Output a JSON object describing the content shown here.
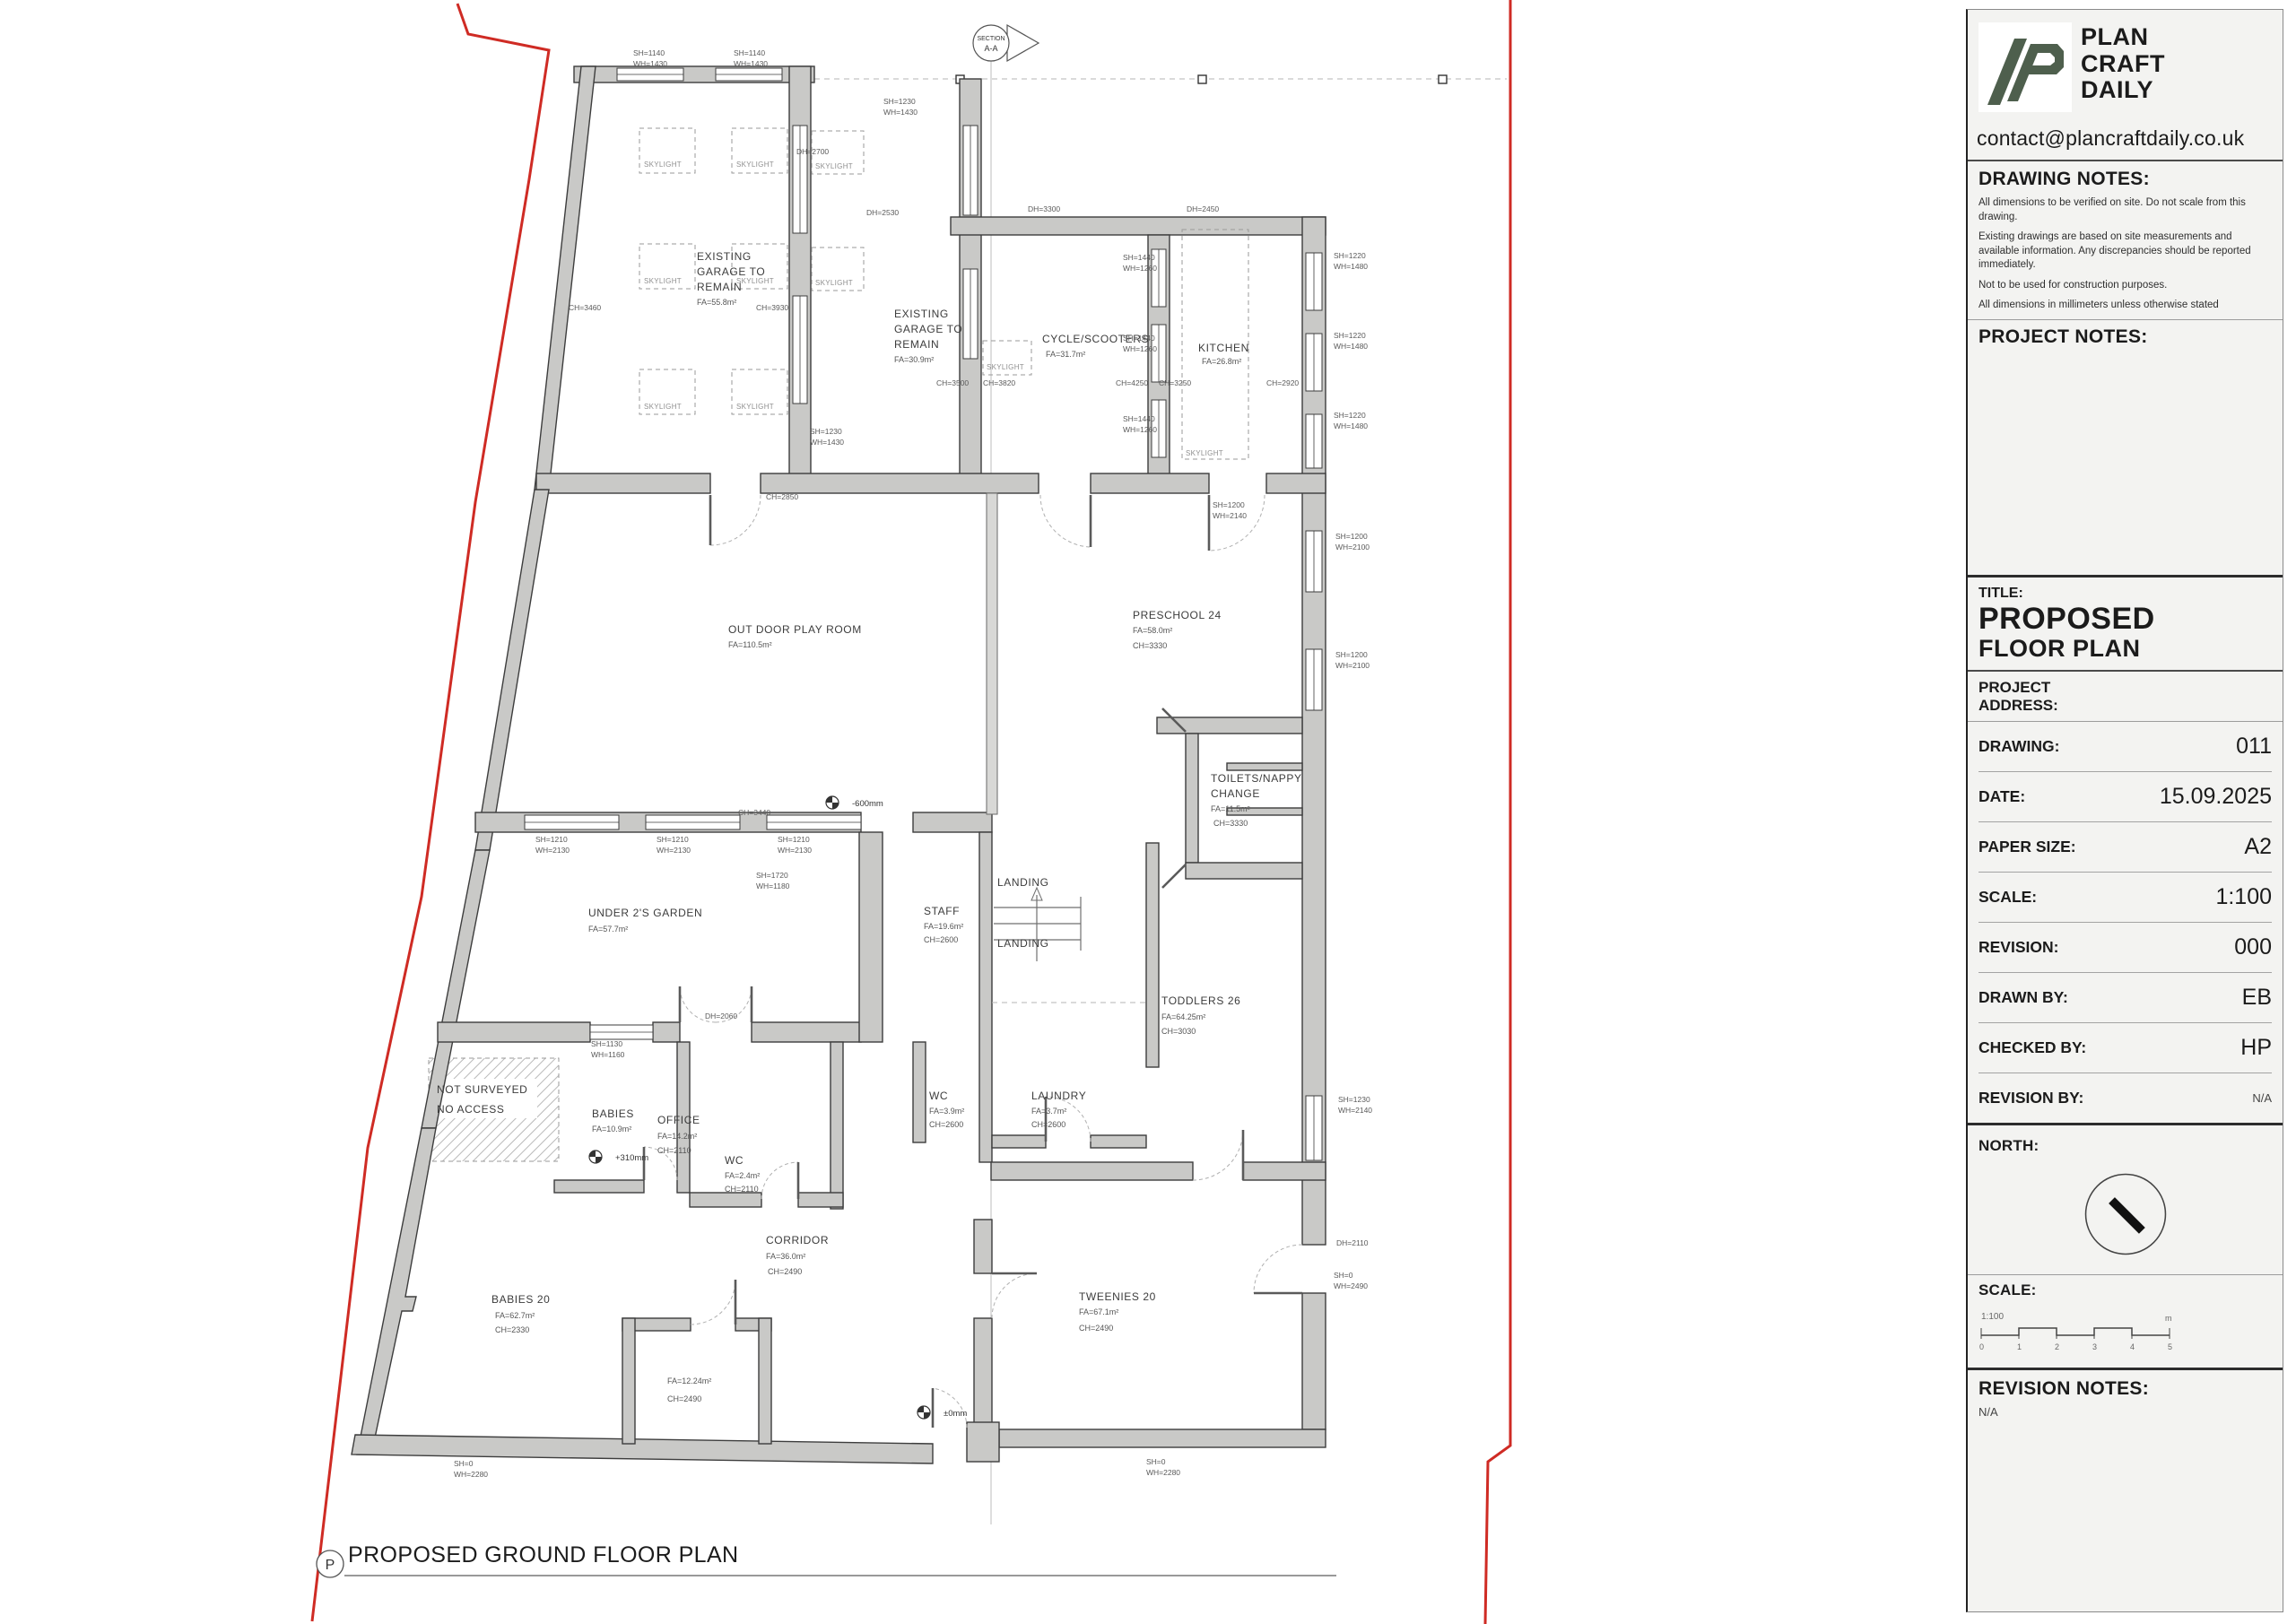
{
  "colors": {
    "logo_green": "#4e5f4d",
    "boundary_red": "#cf2b24",
    "wall_gray": "#c9c9c7"
  },
  "title_block": {
    "brand": {
      "name_lines": [
        "PLAN",
        "CRAFT",
        "DAILY"
      ],
      "email": "contact@plancraftdaily.co.uk"
    },
    "drawing_notes": {
      "heading": "DRAWING NOTES:",
      "notes": [
        "All dimensions to be verified on site. Do not scale from this drawing.",
        "Existing drawings are based on site measurements and available information. Any discrepancies should be reported immediately.",
        "Not to be used for construction purposes.",
        "All dimensions in millimeters unless otherwise stated"
      ]
    },
    "project_notes": {
      "heading": "PROJECT NOTES:"
    },
    "title": {
      "label": "TITLE:",
      "line1": "PROPOSED",
      "line2": "FLOOR PLAN"
    },
    "address_label": "PROJECT\nADDRESS:",
    "fields": [
      {
        "label": "DRAWING:",
        "value": "011"
      },
      {
        "label": "DATE:",
        "value": "15.09.2025"
      },
      {
        "label": "PAPER SIZE:",
        "value": "A2"
      },
      {
        "label": "SCALE:",
        "value": "1:100"
      },
      {
        "label": "REVISION:",
        "value": "000"
      },
      {
        "label": "DRAWN BY:",
        "value": "EB"
      },
      {
        "label": "CHECKED BY:",
        "value": "HP"
      },
      {
        "label": "REVISION BY:",
        "value": "N/A"
      }
    ],
    "north_label": "NORTH:",
    "scale_bar": {
      "label": "SCALE:",
      "ratio": "1:100",
      "ticks": [
        "0",
        "1",
        "2",
        "3",
        "4",
        "5"
      ],
      "unit": "m"
    },
    "revision_notes": {
      "heading": "REVISION NOTES:",
      "value": "N/A"
    }
  },
  "plan": {
    "caption": {
      "marker": "P",
      "title": "PROPOSED GROUND FLOOR PLAN"
    },
    "section_marker": {
      "line1": "SECTION",
      "line2": "A-A"
    },
    "labels": [
      [
        "EXISTING",
        777,
        290,
        "room"
      ],
      [
        "GARAGE TO",
        777,
        307,
        "room"
      ],
      [
        "REMAIN",
        777,
        324,
        "room"
      ],
      [
        "FA=55.8m²",
        777,
        340,
        "sub"
      ],
      [
        "EXISTING",
        997,
        354,
        "room"
      ],
      [
        "GARAGE TO",
        997,
        371,
        "room"
      ],
      [
        "REMAIN",
        997,
        388,
        "room"
      ],
      [
        "FA=30.9m²",
        997,
        404,
        "sub"
      ],
      [
        "CYCLE/SCOOTERS",
        1162,
        382,
        "room"
      ],
      [
        "FA=31.7m²",
        1166,
        398,
        "sub"
      ],
      [
        "KITCHEN",
        1336,
        392,
        "room"
      ],
      [
        "FA=26.8m²",
        1340,
        406,
        "sub"
      ],
      [
        "OUT DOOR PLAY ROOM",
        812,
        706,
        "room"
      ],
      [
        "FA=110.5m²",
        812,
        722,
        "sub"
      ],
      [
        "PRESCHOOL 24",
        1263,
        690,
        "room"
      ],
      [
        "FA=58.0m²",
        1263,
        706,
        "sub"
      ],
      [
        "CH=3330",
        1263,
        723,
        "sub"
      ],
      [
        "TOILETS/NAPPY",
        1350,
        872,
        "room"
      ],
      [
        "CHANGE",
        1350,
        889,
        "room"
      ],
      [
        "FA=11.5m²",
        1350,
        905,
        "sub"
      ],
      [
        "CH=3330",
        1353,
        921,
        "sub"
      ],
      [
        "UNDER 2'S GARDEN",
        656,
        1022,
        "room"
      ],
      [
        "FA=57.7m²",
        656,
        1039,
        "sub"
      ],
      [
        "STAFF",
        1030,
        1020,
        "room"
      ],
      [
        "FA=19.6m²",
        1030,
        1036,
        "sub"
      ],
      [
        "CH=2600",
        1030,
        1051,
        "sub"
      ],
      [
        "LANDING",
        1112,
        988,
        "room"
      ],
      [
        "LANDING",
        1112,
        1056,
        "room"
      ],
      [
        "TODDLERS 26",
        1295,
        1120,
        "room"
      ],
      [
        "FA=64.25m²",
        1295,
        1137,
        "sub"
      ],
      [
        "CH=3030",
        1295,
        1153,
        "sub"
      ],
      [
        "NOT SURVEYED",
        487,
        1219,
        "room"
      ],
      [
        "NO ACCESS",
        487,
        1241,
        "room"
      ],
      [
        "BABIES",
        660,
        1246,
        "room"
      ],
      [
        "FA=10.9m²",
        660,
        1262,
        "sub"
      ],
      [
        "OFFICE",
        733,
        1253,
        "room"
      ],
      [
        "FA=14.2m²",
        733,
        1270,
        "sub"
      ],
      [
        "CH=2110",
        733,
        1286,
        "sub"
      ],
      [
        "WC",
        1036,
        1226,
        "room"
      ],
      [
        "FA=3.9m²",
        1036,
        1242,
        "sub"
      ],
      [
        "CH=2600",
        1036,
        1257,
        "sub"
      ],
      [
        "LAUNDRY",
        1150,
        1226,
        "room"
      ],
      [
        "FA=3.7m²",
        1150,
        1242,
        "sub"
      ],
      [
        "CH=2600",
        1150,
        1257,
        "sub"
      ],
      [
        "WC",
        808,
        1298,
        "room"
      ],
      [
        "FA=2.4m²",
        808,
        1314,
        "sub"
      ],
      [
        "CH=2110",
        808,
        1329,
        "sub"
      ],
      [
        "CORRIDOR",
        854,
        1387,
        "room"
      ],
      [
        "FA=36.0m²",
        854,
        1404,
        "sub"
      ],
      [
        "CH=2490",
        856,
        1421,
        "sub"
      ],
      [
        "BABIES 20",
        548,
        1453,
        "room"
      ],
      [
        "FA=62.7m²",
        552,
        1470,
        "sub"
      ],
      [
        "CH=2330",
        552,
        1486,
        "sub"
      ],
      [
        "FA=12.24m²",
        744,
        1543,
        "sub"
      ],
      [
        "CH=2490",
        744,
        1563,
        "sub"
      ],
      [
        "TWEENIES 20",
        1203,
        1450,
        "room"
      ],
      [
        "FA=67.1m²",
        1203,
        1466,
        "sub"
      ],
      [
        "CH=2490",
        1203,
        1484,
        "sub"
      ],
      [
        "SKYLIGHT",
        718,
        186,
        "skl"
      ],
      [
        "SKYLIGHT",
        821,
        186,
        "skl"
      ],
      [
        "SKYLIGHT",
        718,
        316,
        "skl"
      ],
      [
        "SKYLIGHT",
        821,
        316,
        "skl"
      ],
      [
        "SKYLIGHT",
        718,
        456,
        "skl"
      ],
      [
        "SKYLIGHT",
        821,
        456,
        "skl"
      ],
      [
        "SKYLIGHT",
        909,
        188,
        "skl"
      ],
      [
        "SKYLIGHT",
        909,
        318,
        "skl"
      ],
      [
        "SKYLIGHT",
        1100,
        412,
        "skl"
      ],
      [
        "SKYLIGHT",
        1322,
        508,
        "skl"
      ],
      [
        "SH=1140",
        706,
        62,
        "dim"
      ],
      [
        "WH=1430",
        706,
        74,
        "dim"
      ],
      [
        "SH=1140",
        818,
        62,
        "dim"
      ],
      [
        "WH=1430",
        818,
        74,
        "dim"
      ],
      [
        "DH=2700",
        888,
        172,
        "dim"
      ],
      [
        "SH=1230",
        985,
        116,
        "dim"
      ],
      [
        "WH=1430",
        985,
        128,
        "dim"
      ],
      [
        "DH=2530",
        966,
        240,
        "dim"
      ],
      [
        "DH=3300",
        1146,
        236,
        "dim"
      ],
      [
        "DH=2450",
        1323,
        236,
        "dim"
      ],
      [
        "SH=1440",
        1252,
        290,
        "dim"
      ],
      [
        "WH=1260",
        1252,
        302,
        "dim"
      ],
      [
        "SH=1440",
        1252,
        380,
        "dim"
      ],
      [
        "WH=1260",
        1252,
        392,
        "dim"
      ],
      [
        "SH=1440",
        1252,
        470,
        "dim"
      ],
      [
        "WH=1260",
        1252,
        482,
        "dim"
      ],
      [
        "SH=1220",
        1487,
        288,
        "dim"
      ],
      [
        "WH=1480",
        1487,
        300,
        "dim"
      ],
      [
        "SH=1220",
        1487,
        377,
        "dim"
      ],
      [
        "WH=1480",
        1487,
        389,
        "dim"
      ],
      [
        "SH=1220",
        1487,
        466,
        "dim"
      ],
      [
        "WH=1480",
        1487,
        478,
        "dim"
      ],
      [
        "CH=3460",
        634,
        346,
        "dim"
      ],
      [
        "CH=3930",
        843,
        346,
        "dim"
      ],
      [
        "CH=3500",
        1044,
        430,
        "dim"
      ],
      [
        "CH=3820",
        1096,
        430,
        "dim"
      ],
      [
        "CH=4250",
        1244,
        430,
        "dim"
      ],
      [
        "CH=3250",
        1292,
        430,
        "dim"
      ],
      [
        "CH=2920",
        1412,
        430,
        "dim"
      ],
      [
        "SH=1230",
        903,
        484,
        "dim"
      ],
      [
        "WH=1430",
        903,
        496,
        "dim"
      ],
      [
        "CH=2850",
        854,
        557,
        "dim"
      ],
      [
        "SH=1200",
        1352,
        566,
        "dim"
      ],
      [
        "WH=2140",
        1352,
        578,
        "dim"
      ],
      [
        "SH=1200",
        1489,
        601,
        "dim"
      ],
      [
        "WH=2100",
        1489,
        613,
        "dim"
      ],
      [
        "SH=1200",
        1489,
        733,
        "dim"
      ],
      [
        "WH=2100",
        1489,
        745,
        "dim"
      ],
      [
        "SH=1210",
        597,
        939,
        "dim"
      ],
      [
        "WH=2130",
        597,
        951,
        "dim"
      ],
      [
        "SH=1210",
        732,
        939,
        "dim"
      ],
      [
        "WH=2130",
        732,
        951,
        "dim"
      ],
      [
        "SH=1210",
        867,
        939,
        "dim"
      ],
      [
        "WH=2130",
        867,
        951,
        "dim"
      ],
      [
        "CH=3440",
        823,
        909,
        "dim"
      ],
      [
        "SH=1720",
        843,
        979,
        "dim"
      ],
      [
        "WH=1180",
        843,
        991,
        "dim"
      ],
      [
        "DH=2060",
        786,
        1136,
        "dim"
      ],
      [
        "SH=1130",
        659,
        1167,
        "dim"
      ],
      [
        "WH=1160",
        659,
        1179,
        "dim"
      ],
      [
        "SH=1230",
        1492,
        1229,
        "dim"
      ],
      [
        "WH=2140",
        1492,
        1241,
        "dim"
      ],
      [
        "DH=2110",
        1490,
        1389,
        "dim"
      ],
      [
        "SH=0",
        1487,
        1425,
        "dim"
      ],
      [
        "WH=2490",
        1487,
        1437,
        "dim"
      ],
      [
        "SH=0",
        506,
        1635,
        "dim"
      ],
      [
        "WH=2280",
        506,
        1647,
        "dim"
      ],
      [
        "SH=0",
        1278,
        1633,
        "dim"
      ],
      [
        "WH=2280",
        1278,
        1645,
        "dim"
      ],
      [
        "-600mm",
        950,
        899,
        "lvl"
      ],
      [
        "+310mm",
        686,
        1294,
        "lvl"
      ],
      [
        "±0mm",
        1052,
        1579,
        "lvl"
      ]
    ]
  }
}
